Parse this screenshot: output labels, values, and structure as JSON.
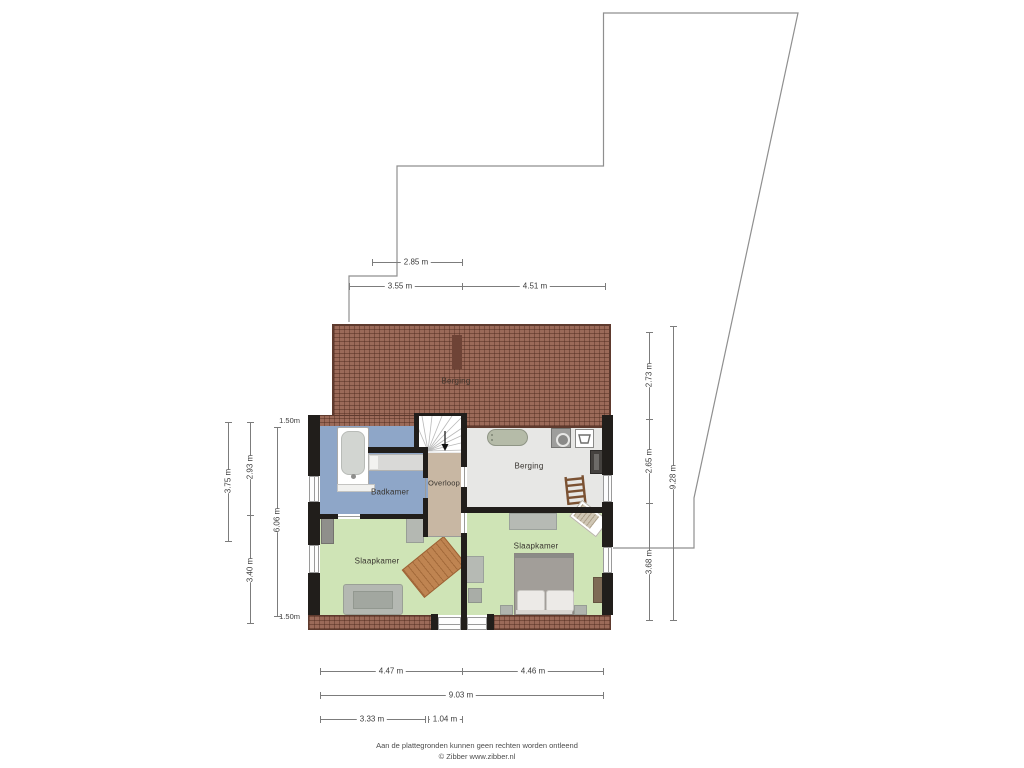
{
  "rooms": {
    "attic": {
      "label": "Berging"
    },
    "badkamer": {
      "label": "Badkamer"
    },
    "overloop": {
      "label": "Overloop"
    },
    "berging": {
      "label": "Berging"
    },
    "slaapkamer_left": {
      "label": "Slaapkamer"
    },
    "slaapkamer_right": {
      "label": "Slaapkamer"
    }
  },
  "dimensions": {
    "top": [
      {
        "label": "2.85 m"
      },
      {
        "label": "3.55 m"
      },
      {
        "label": "4.51 m"
      }
    ],
    "left": [
      {
        "label": "3.75 m"
      },
      {
        "label": "2.93 m"
      },
      {
        "label": "3.40 m"
      },
      {
        "label": "6.06 m"
      }
    ],
    "right": [
      {
        "label": "2.73 m"
      },
      {
        "label": "2.65 m"
      },
      {
        "label": "3.68 m"
      },
      {
        "label": "9.28 m"
      }
    ],
    "bottom": [
      {
        "label": "4.47 m"
      },
      {
        "label": "4.46 m"
      },
      {
        "label": "9.03 m"
      },
      {
        "label": "3.33 m"
      },
      {
        "label": "1.04 m"
      }
    ],
    "height_markers": [
      {
        "label": "1.50m"
      },
      {
        "label": "1.50m"
      }
    ]
  },
  "footer": {
    "disclaimer": "Aan de plattegronden kunnen geen rechten worden ontleend",
    "credit": "© Zibber www.zibber.nl"
  },
  "colors": {
    "wall": "#211e1b",
    "roof": "#9b6a59",
    "badkamer_floor": "#8ea6c8",
    "overloop_floor": "#c8b7a3",
    "berging_floor": "#e7e7e5",
    "slaapkamer_floor": "#cfe4b6",
    "dimension_text": "#3c3c3c",
    "outline": "#8f8f8f"
  }
}
